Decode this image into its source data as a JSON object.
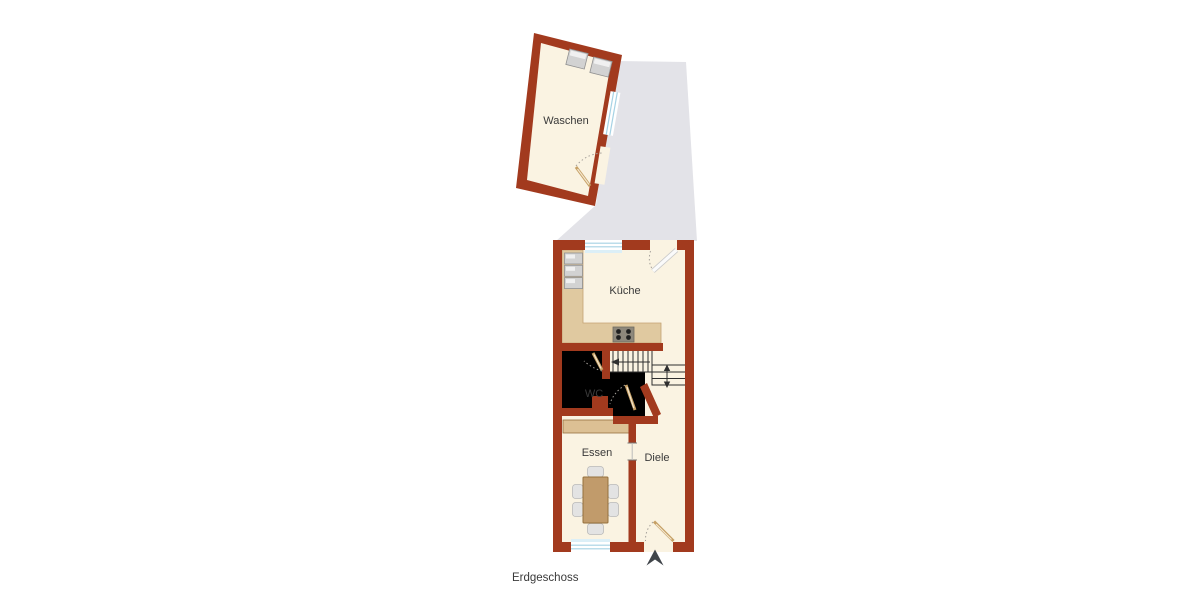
{
  "floor_plan": {
    "floor_label": "Erdgeschoss",
    "rooms": {
      "waschen": {
        "label": "Waschen"
      },
      "kueche": {
        "label": "Küche"
      },
      "wc": {
        "label": "WC"
      },
      "essen": {
        "label": "Essen"
      },
      "diele": {
        "label": "Diele"
      }
    },
    "icons": {
      "north_arrow": "▲"
    }
  },
  "colors": {
    "wall": "#A23A1E",
    "floor": "#FAF3E2",
    "courtyard": "#E3E3E8",
    "counter": "#E0C9A0",
    "counterEdge": "#C3A273",
    "sideboard": "#DCC094",
    "wood": "#C19B6B",
    "woodEdge": "#95703E",
    "chair": "#E3E3E3",
    "chairEdge": "#B9B9B9",
    "appliance": "#D2D2D2",
    "applianceEdge": "#909090",
    "applianceHl": "#F0F0F0",
    "stove": "#8E887C",
    "stairLine": "#2F2F2F",
    "windowBlue": "#A6D2E4",
    "sill": "#DCEFF7",
    "doorTan": "#C6A065",
    "doorLight": "#F3E6CF",
    "swing": "#A5A09A",
    "text": "#3A3A3A",
    "northArrow": "#40454A"
  }
}
